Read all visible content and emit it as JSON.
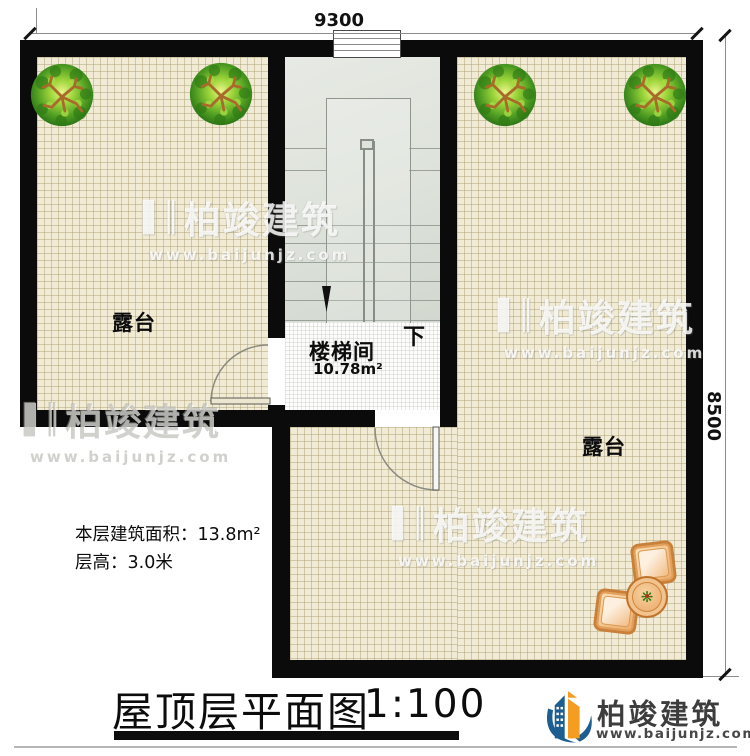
{
  "plan": {
    "title": "屋顶层平面图",
    "scale": "1:100",
    "dim_top": "9300",
    "dim_right": "8500",
    "rooms": {
      "terrace_left": {
        "label": "露台"
      },
      "terrace_right": {
        "label": "露台"
      },
      "stairwell": {
        "label": "楼梯间",
        "area": "10.78m²",
        "direction_down": "下"
      }
    },
    "notes": {
      "area_line": "本层建筑面积：13.8m²",
      "height_line": "层高：3.0米"
    },
    "colors": {
      "wall": "#0b0b0b",
      "floor_tile": "#f1ebd6",
      "stair": "#dde2da",
      "accent_orange": "#f59d20",
      "logo_blue": "#1d5e90"
    }
  },
  "watermark": {
    "mark": "▌║",
    "brand": "柏竣建筑",
    "url": "www.baijunjz.com"
  },
  "logo": {
    "brand": "柏竣建筑",
    "url": "www.baijunjz.com"
  }
}
